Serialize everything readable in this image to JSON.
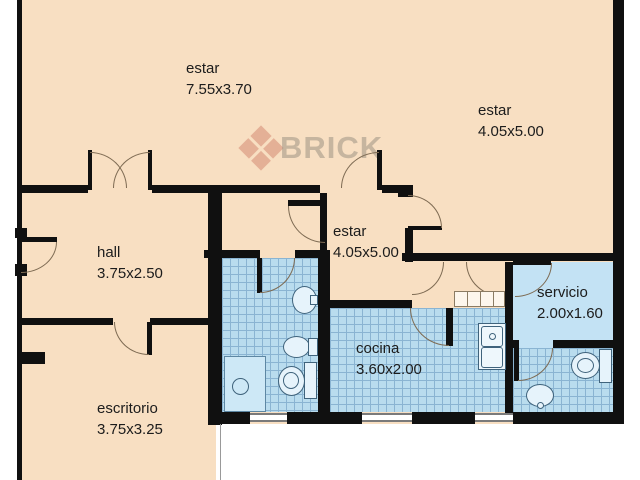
{
  "plan": {
    "watermark": "BRICK",
    "rooms": [
      {
        "name": "estar",
        "dims": "7.55x3.70"
      },
      {
        "name": "estar",
        "dims": "4.05x5.00"
      },
      {
        "name": "hall",
        "dims": "3.75x2.50"
      },
      {
        "name": "estar",
        "dims": "4.05x5.00"
      },
      {
        "name": "cocina",
        "dims": "3.60x2.00"
      },
      {
        "name": "servicio",
        "dims": "2.00x1.60"
      },
      {
        "name": "escritorio",
        "dims": "3.75x3.25"
      }
    ],
    "colors": {
      "floor": "#f8dfc2",
      "wall": "#101010",
      "tile": "#b9dcee",
      "tile_line": "#8ab4d2",
      "servicio_floor": "#c3e2f4",
      "shower": "#cde8f6",
      "fixture_fill": "#e6f3fb",
      "fixture_line": "#3f637c",
      "door_arc": "#7d6a52"
    },
    "fixtures": [
      "shower",
      "drain",
      "washbasin",
      "bidet",
      "toilet",
      "kitchen-sink",
      "closet",
      "toilet",
      "washbasin"
    ]
  }
}
